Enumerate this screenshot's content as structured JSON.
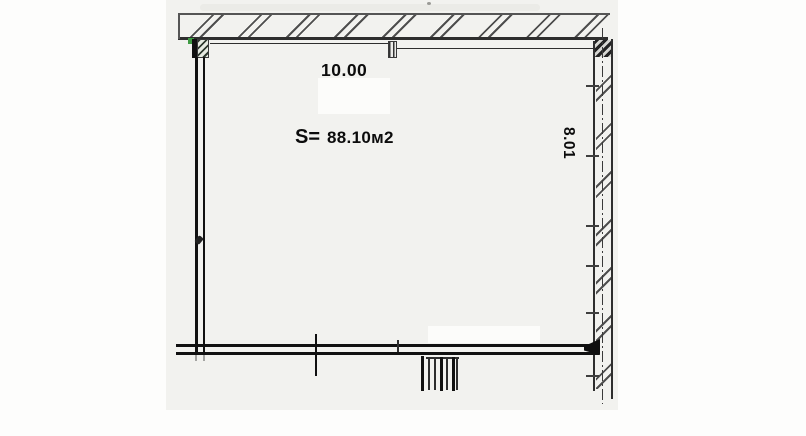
{
  "drawing": {
    "width_label": "10.00",
    "area_prefix": "S=",
    "area_value": "88.10м2",
    "height_label": "8.01"
  },
  "colors": {
    "line_ink": "#111111",
    "hatch": "#4e4e4e",
    "paper_tint": "#f2f2ef",
    "accent_green": "#3f9b43"
  }
}
